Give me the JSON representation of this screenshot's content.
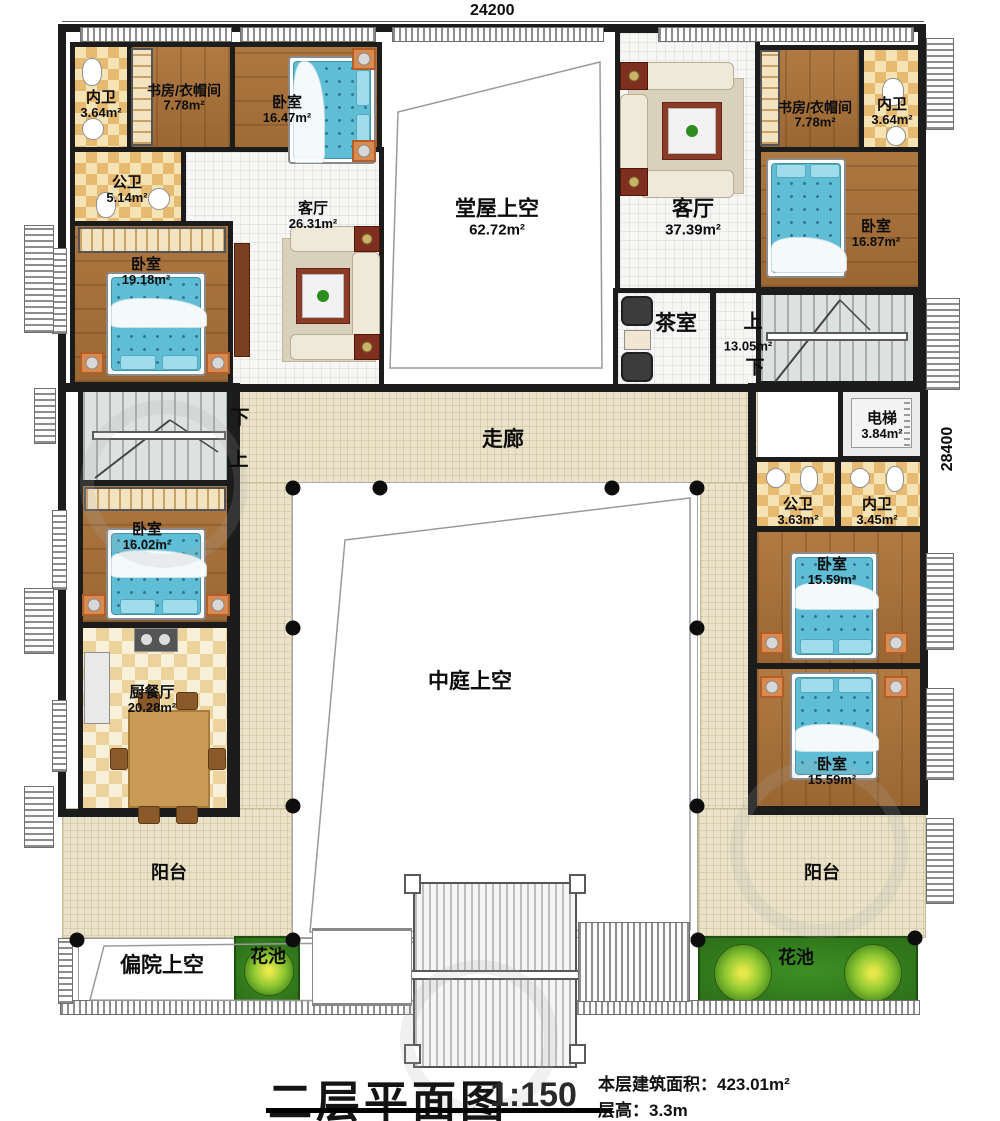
{
  "dimensions": {
    "top": "24200",
    "right": "28400"
  },
  "title": {
    "name": "二层平面图",
    "scale": "1:150",
    "area_label": "本层建筑面积：",
    "area_value": "423.01m²",
    "height_label": "层高：",
    "height_value": "3.3m"
  },
  "stairs": {
    "up": "上",
    "down": "下",
    "hall_area": "13.05m²"
  },
  "rooms": {
    "nw_neiwei": {
      "name": "内卫",
      "area": "3.64m²"
    },
    "nw_study": {
      "name": "书房/衣帽间",
      "area": "7.78m²"
    },
    "nw_bed": {
      "name": "卧室",
      "area": "16.47m²"
    },
    "tangwu": {
      "name": "堂屋上空",
      "area": "62.72m²"
    },
    "ne_living": {
      "name": "客厅",
      "area": "37.39m²"
    },
    "ne_study": {
      "name": "书房/衣帽间",
      "area": "7.78m²"
    },
    "ne_neiwei": {
      "name": "内卫",
      "area": "3.64m²"
    },
    "ne_bed": {
      "name": "卧室",
      "area": "16.87m²"
    },
    "w_gongwei": {
      "name": "公卫",
      "area": "5.14m²"
    },
    "w_living": {
      "name": "客厅",
      "area": "26.31m²"
    },
    "w_bed": {
      "name": "卧室",
      "area": "19.18m²"
    },
    "tea": {
      "name": "茶室"
    },
    "elevator": {
      "name": "电梯",
      "area": "3.84m²"
    },
    "e_gongwei": {
      "name": "公卫",
      "area": "3.63m²"
    },
    "e_neiwei": {
      "name": "内卫",
      "area": "3.45m²"
    },
    "e_bed1": {
      "name": "卧室",
      "area": "15.59m²"
    },
    "e_bed2": {
      "name": "卧室",
      "area": "15.59m²"
    },
    "w_bed2": {
      "name": "卧室",
      "area": "16.02m²"
    },
    "kitchen": {
      "name": "厨餐厅",
      "area": "20.28m²"
    },
    "corridor": {
      "name": "走廊"
    },
    "courtyard": {
      "name": "中庭上空"
    },
    "balcony_left": {
      "name": "阳台"
    },
    "balcony_right": {
      "name": "阳台"
    },
    "side_yard": {
      "name": "偏院上空"
    },
    "flower_left": {
      "name": "花池"
    },
    "flower_right": {
      "name": "花池"
    }
  }
}
